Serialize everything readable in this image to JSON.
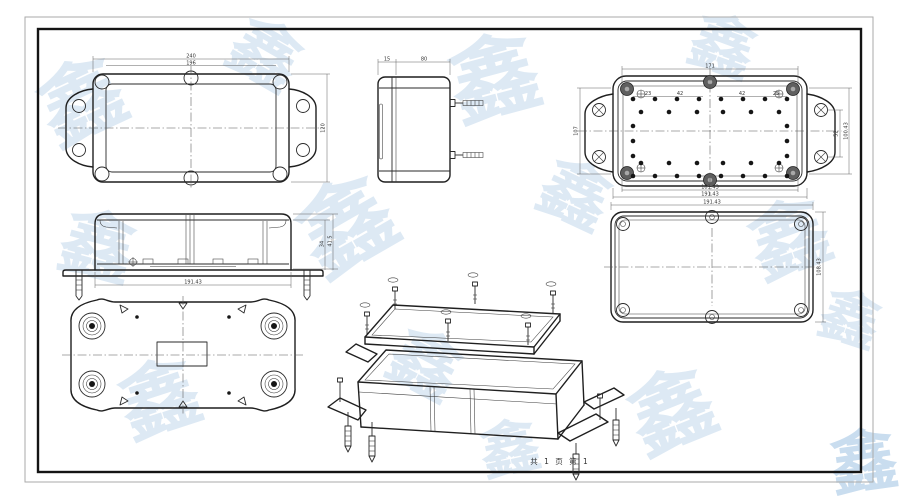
{
  "sheet": {
    "footer_text": "共 1 页  第 1"
  },
  "watermark": {
    "glyph": "鑫"
  },
  "dimensions": {
    "top_view": {
      "outer_width": "240",
      "inner_width": "196",
      "height": "120"
    },
    "side_view": {
      "lid_depth": "15",
      "body_depth": "80"
    },
    "base_view": {
      "top_span": "171",
      "sp1": "23",
      "sp2": "42",
      "sp3": "42",
      "sp4": "25",
      "left_height": "107",
      "right_inner": "52",
      "right_outer": "100.43",
      "bottom_inner": "181.43",
      "bottom_outer": "191.43"
    },
    "lid_view": {
      "width": "191.43",
      "height": "108.43"
    },
    "elevation_view": {
      "inner_height": "34",
      "outer_height": "41.5",
      "width": "191.43"
    }
  }
}
